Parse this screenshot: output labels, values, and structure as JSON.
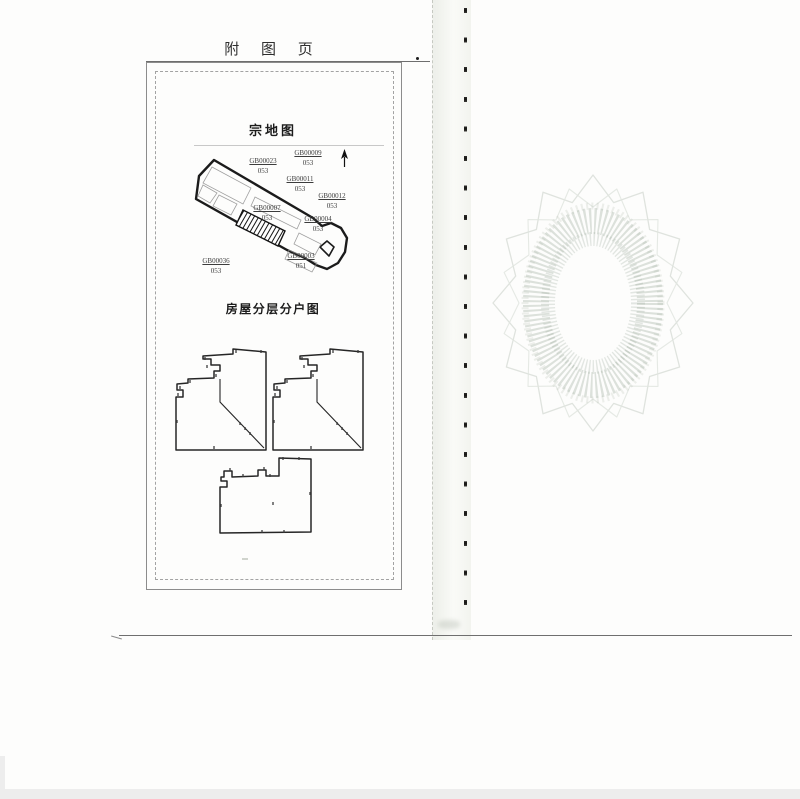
{
  "page": {
    "header_title": "附 图 页"
  },
  "parcel_map": {
    "title": "宗地图",
    "parcels": [
      {
        "code": "GB00023",
        "number": "053"
      },
      {
        "code": "GB00009",
        "number": "053"
      },
      {
        "code": "GB00011",
        "number": "053"
      },
      {
        "code": "GB00012",
        "number": "053"
      },
      {
        "code": "GB00007",
        "number": "053"
      },
      {
        "code": "GB00004",
        "number": "053"
      },
      {
        "code": "GB00036",
        "number": "053"
      },
      {
        "code": "GB00003",
        "number": "051"
      }
    ],
    "icons": {
      "north_arrow": "north-arrow-icon"
    }
  },
  "floor_plans": {
    "title": "房屋分层分户图"
  },
  "colors": {
    "ink": "#262626",
    "watermark_green": "#9caa9c",
    "gutter_tint": "#e4e8dd"
  }
}
